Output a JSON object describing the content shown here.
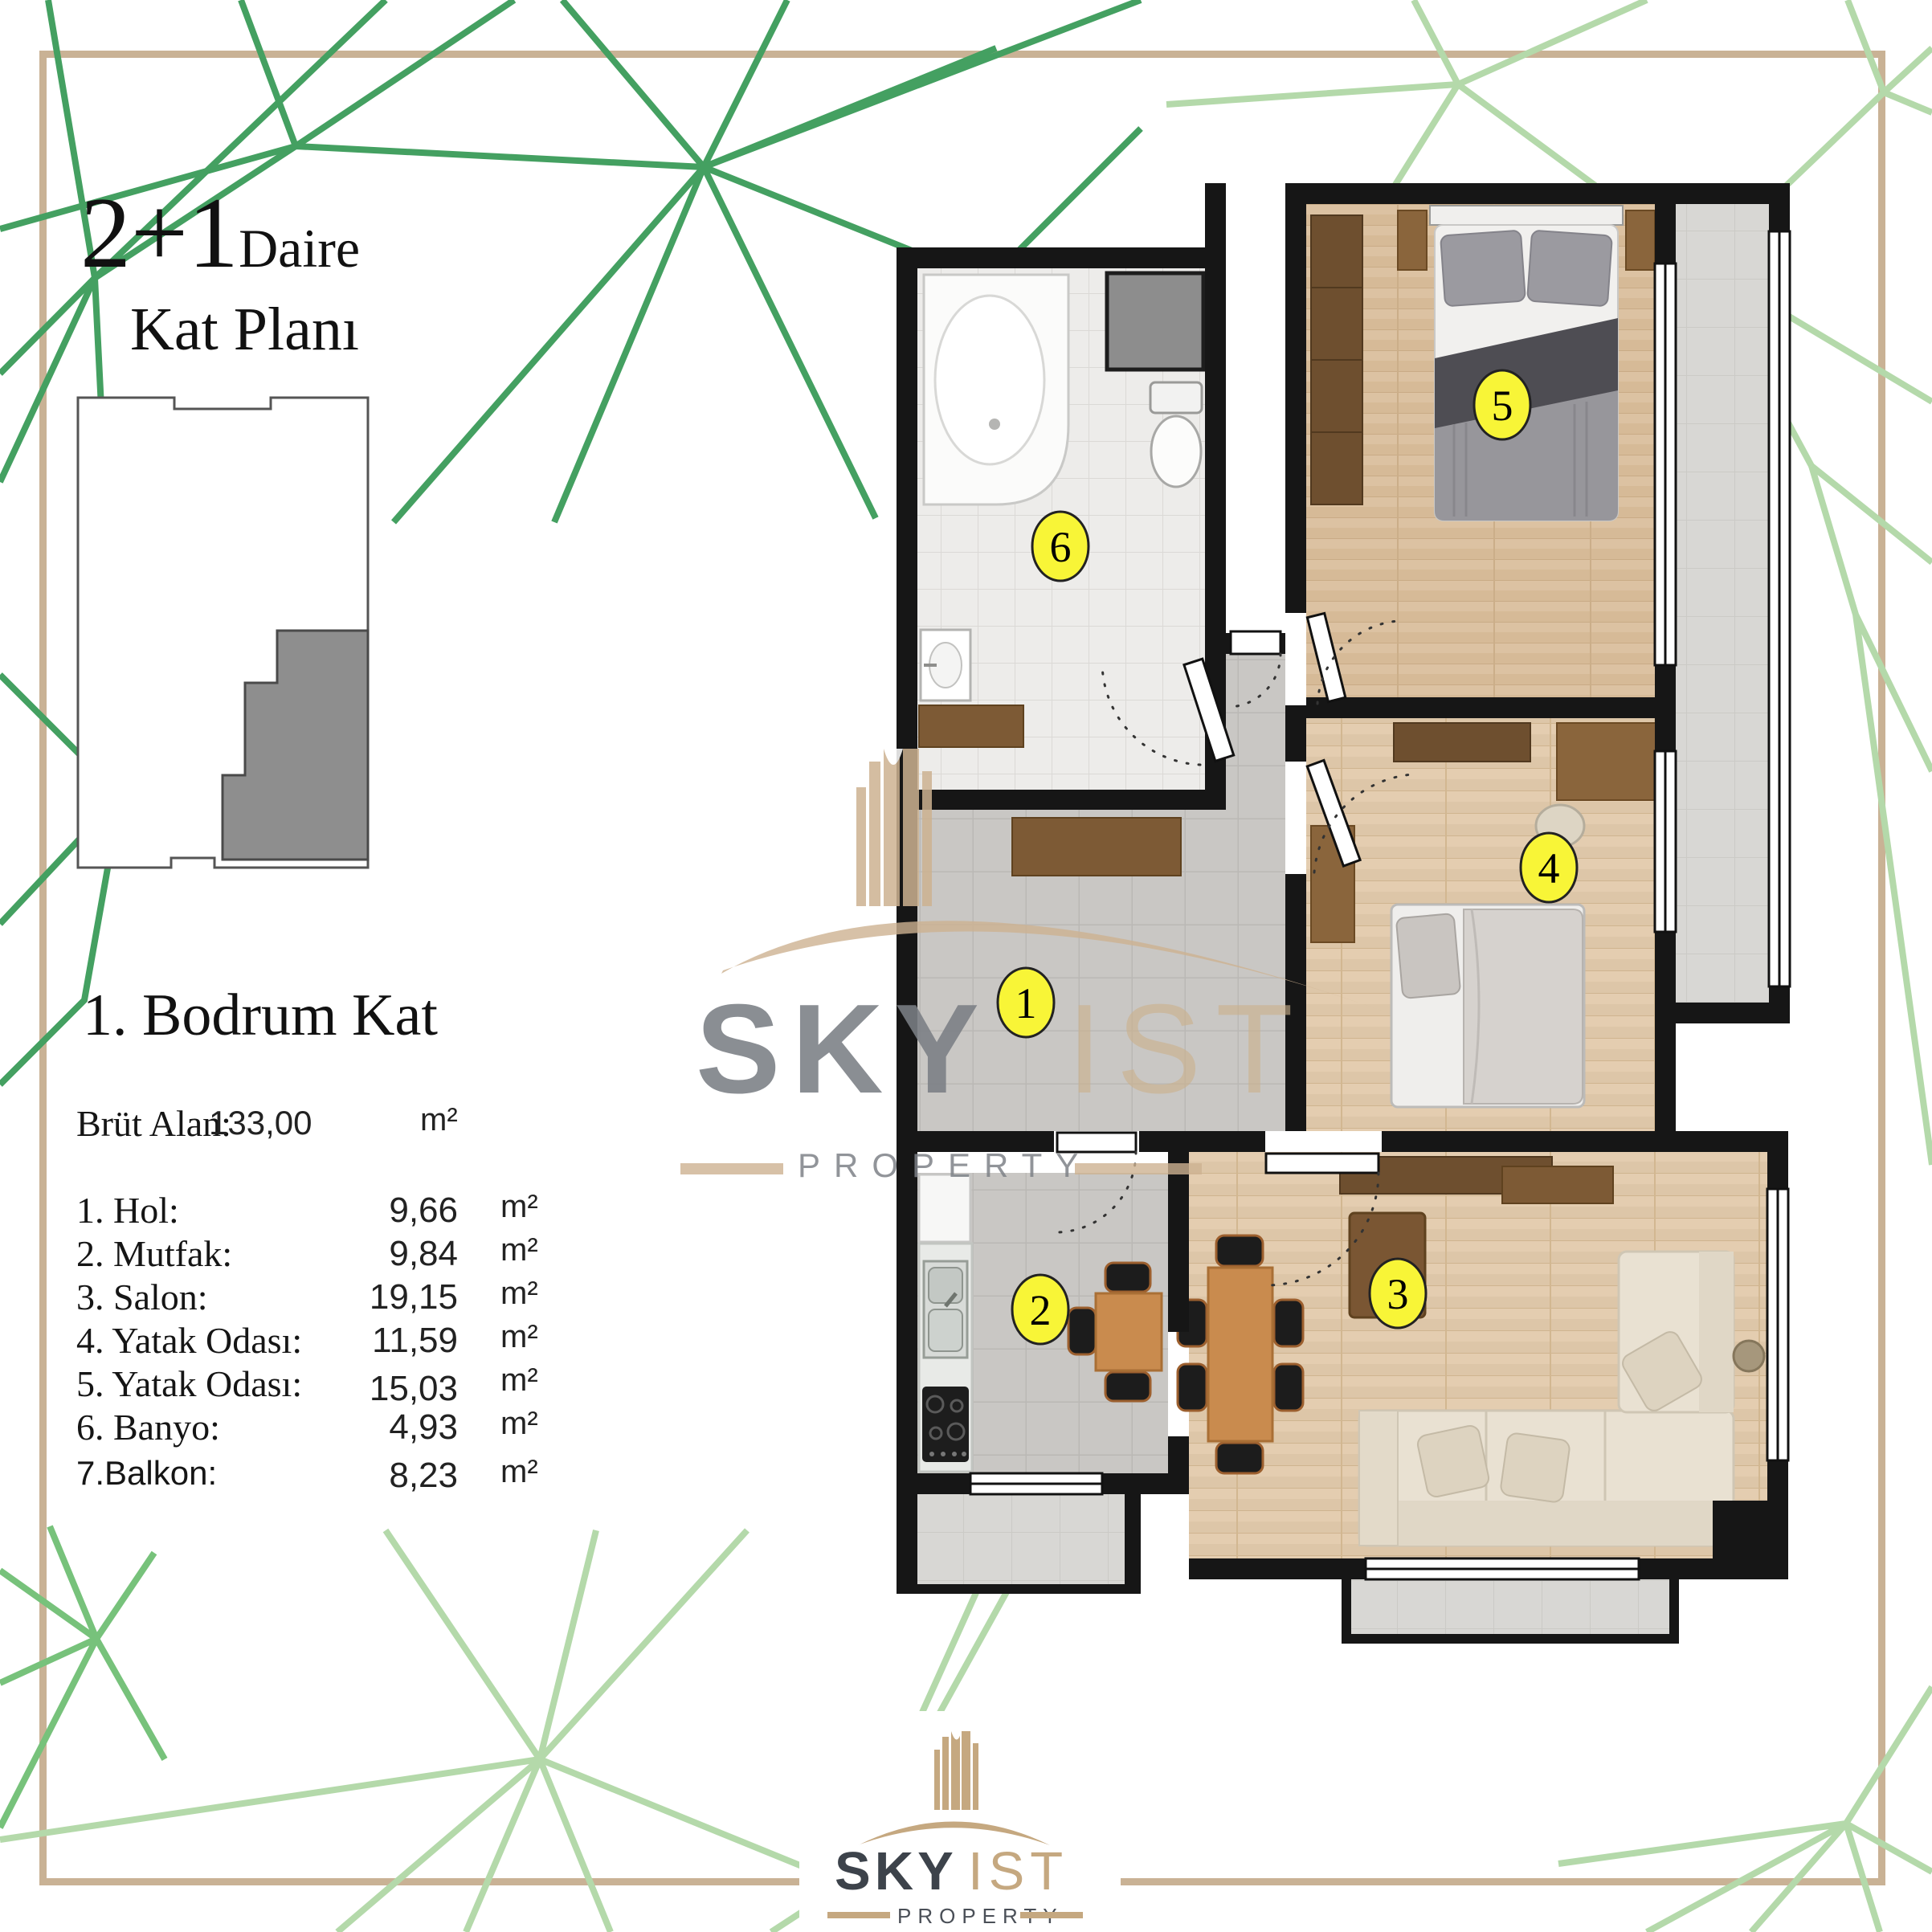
{
  "page": {
    "background": "#ffffff",
    "frame_color": "#c9b295",
    "green_dark": "#44a061",
    "green_mid": "#6fbd72",
    "green_light": "#b4d9aa",
    "wall_color": "#161616",
    "label_circle_color": "#f8f537"
  },
  "header": {
    "title_big": "2+1",
    "title_small": "Daire",
    "subtitle": "Kat Planı"
  },
  "floor_section": {
    "heading": "1. Bodrum Kat",
    "gross": {
      "label": "Brüt Alan:",
      "value": "133,00",
      "unit": "m²"
    },
    "rooms": [
      {
        "label": "1. Hol:",
        "value": "9,66",
        "unit": "m²"
      },
      {
        "label": "2. Mutfak:",
        "value": "9,84",
        "unit": "m²"
      },
      {
        "label": "3. Salon:",
        "value": "19,15",
        "unit": "m²"
      },
      {
        "label": "4. Yatak Odası:",
        "value": "11,59",
        "unit": "m²"
      },
      {
        "label": "5. Yatak Odası:",
        "value": "15,03",
        "unit": "m²"
      },
      {
        "label": "6. Banyo:",
        "value": "4,93",
        "unit": "m²"
      },
      {
        "label": "7.Balkon:",
        "value": "8,23",
        "unit": "m²"
      }
    ]
  },
  "plan": {
    "labels": [
      {
        "number": "1",
        "room": "hol"
      },
      {
        "number": "2",
        "room": "mutfak"
      },
      {
        "number": "3",
        "room": "salon"
      },
      {
        "number": "4",
        "room": "yatak-odasi"
      },
      {
        "number": "5",
        "room": "yatak-odasi"
      },
      {
        "number": "6",
        "room": "banyo"
      }
    ]
  },
  "watermark": {
    "brand_primary": "SKY",
    "brand_secondary": "IST",
    "brand_sub": "PROPERTY"
  },
  "logo": {
    "brand_primary": "SKY",
    "brand_secondary": "IST",
    "brand_sub": "PROPERTY"
  }
}
